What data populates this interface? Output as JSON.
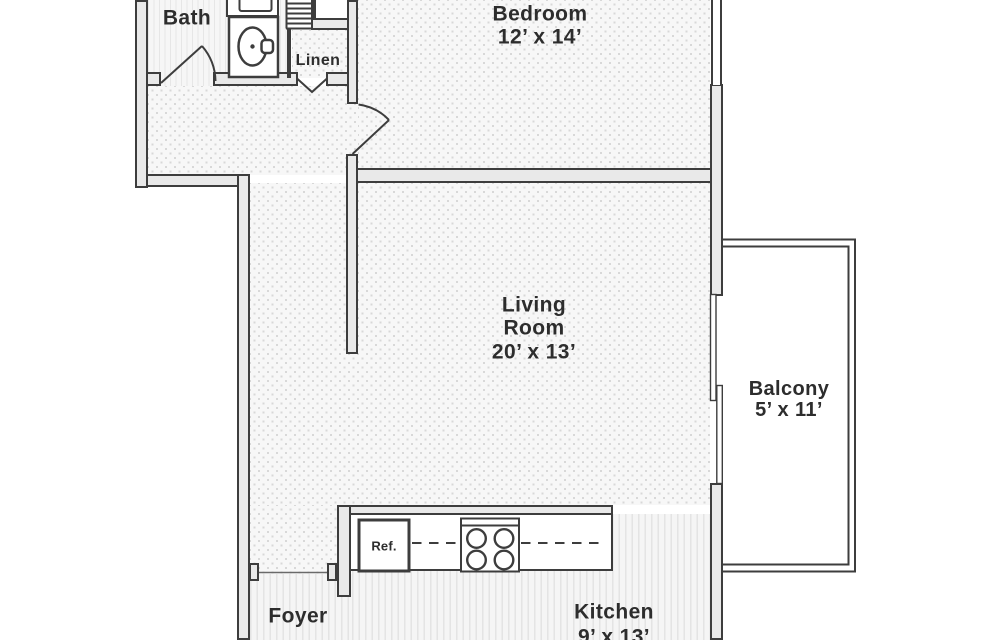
{
  "colors": {
    "line": "#3d3d3d",
    "wall_fill": "#e9e9e9",
    "text": "#2d2d2d",
    "floor_bg": "#f7f7f7",
    "carpet_dot": "#d8d8d8",
    "stripe": "#e4e4e4",
    "stripe_bg": "#f5f5f5"
  },
  "rooms": {
    "bath": {
      "label": "Bath"
    },
    "linen": {
      "label": "Linen"
    },
    "bedroom": {
      "label": "Bedroom",
      "dimensions": "12’ x 14’"
    },
    "living": {
      "label_line1": "Living",
      "label_line2": "Room",
      "dimensions": "20’ x 13’"
    },
    "balcony": {
      "label": "Balcony",
      "dimensions": "5’ x 11’"
    },
    "kitchen": {
      "label": "Kitchen",
      "dimensions": "9’ x 13’"
    },
    "foyer": {
      "label": "Foyer"
    }
  },
  "fixtures": {
    "refrigerator_label": "Ref."
  }
}
